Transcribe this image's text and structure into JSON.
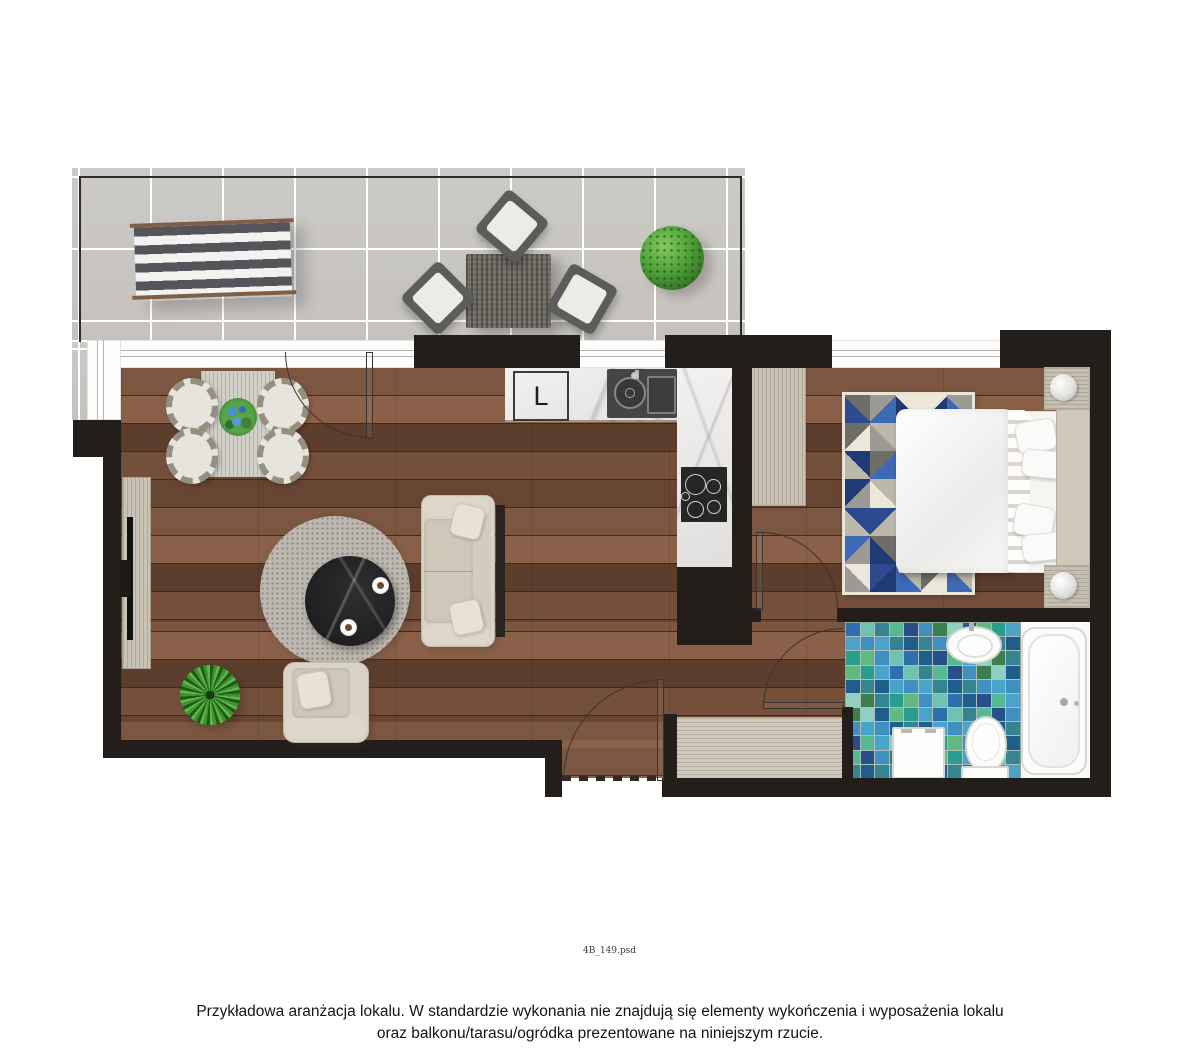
{
  "meta": {
    "file_label": "4B_149.psd"
  },
  "footer": {
    "line1": "Przykładowa aranżacja lokalu. W standardzie wykonania nie znajdują się elementy wykończenia i wyposażenia lokalu",
    "line2": "oraz balkonu/tarasu/ogródka prezentowane na niniejszym rzucie."
  },
  "kitchen": {
    "fridge_label": "L"
  },
  "colors": {
    "wall": "#241e1a",
    "wood_base": "#6a4734",
    "terrace_tile": "#c9c6c2",
    "marble": "#ebe9e7",
    "upholstery": "#d9d3c6",
    "mosaic_grout": "#a9bfba",
    "rug_border": "#e9e4d6"
  },
  "bathroom": {
    "mosaic": {
      "cols": 12,
      "rows": 11,
      "palette": [
        "#2f6fae",
        "#3f8fc0",
        "#2a9d8f",
        "#57b894",
        "#1f5e8a",
        "#6fc3b2",
        "#3b7f4f",
        "#4aa3c8",
        "#274e86",
        "#61b97f",
        "#35848f",
        "#8fd0c0"
      ]
    }
  },
  "bedroom": {
    "rug": {
      "cols": 5,
      "rows": 7,
      "palette": [
        "#2c4a8e",
        "#3e69b4",
        "#9c9a94",
        "#6f6d68",
        "#ece7d9",
        "#bcb8ac",
        "#1f3a74"
      ]
    }
  }
}
